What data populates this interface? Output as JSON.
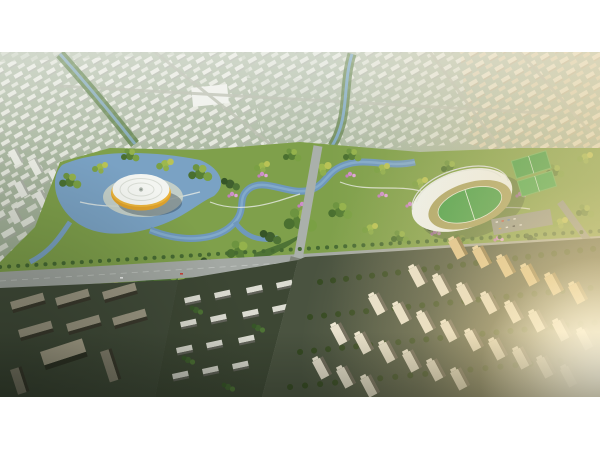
{
  "page": {
    "background": "#ffffff"
  },
  "image": {
    "kind": "architectural-aerial-rendering",
    "alt": "Aerial rendering of a master-planned city district at golden hour: a central park with lakes and a winding river, a round white arena with a glowing yellow rim on the left, a crescent-roofed stadium with a green pitch and practice fields on the right, a wide diagonal boulevard with a central intersection, hazy rows of distant white city blocks above, dark office slabs at lower left and sunlit residential tower rows at lower right with warm sun glare.",
    "letterbox_color": "#ffffff",
    "offset_top_px": 52,
    "width_px": 600,
    "height_px": 345,
    "palette": {
      "haze_green": "#aab7a0",
      "park_green": "#7fa04b",
      "forest_green": "#4e7335",
      "water_blue": "#7aa2c4",
      "pond_cyan": "#5fc0e0",
      "road_gray": "#a4a9a4",
      "arena_yellow": "#eab33a",
      "dome_white": "#f3f5f1",
      "stadium_roof": "#eef3f3",
      "pitch_green": "#3f9d46",
      "track_tan": "#a8a263",
      "blossom_pink": "#cf8fcb",
      "sun_glow": "#ffeec4",
      "dark_ground": "#414b39",
      "tower_warm_white": "#e7e1cf",
      "tower_gold": "#dfc38c"
    },
    "landmarks": [
      {
        "id": "round-arena",
        "label": "white domed arena with yellow rim on lakeside"
      },
      {
        "id": "stadium",
        "label": "crescent white-roofed stadium with green pitch and tan track"
      },
      {
        "id": "practice-fields",
        "label": "two green practice pitches east of stadium"
      },
      {
        "id": "central-park",
        "label": "park band with lakes, winding river, green and pink trees"
      },
      {
        "id": "boulevard",
        "label": "wide diagonal boulevard crossing a north-south road"
      },
      {
        "id": "residential-towers",
        "label": "rows of sunlit residential towers, lower right"
      },
      {
        "id": "rowhouses",
        "label": "low rowhouse blocks, lower center"
      },
      {
        "id": "office-slabs",
        "label": "dark office slabs, lower left"
      },
      {
        "id": "distant-city",
        "label": "hazy distant city blocks and streams, upper area"
      },
      {
        "id": "sun-glare",
        "label": "warm sun glare from lower right"
      }
    ]
  }
}
